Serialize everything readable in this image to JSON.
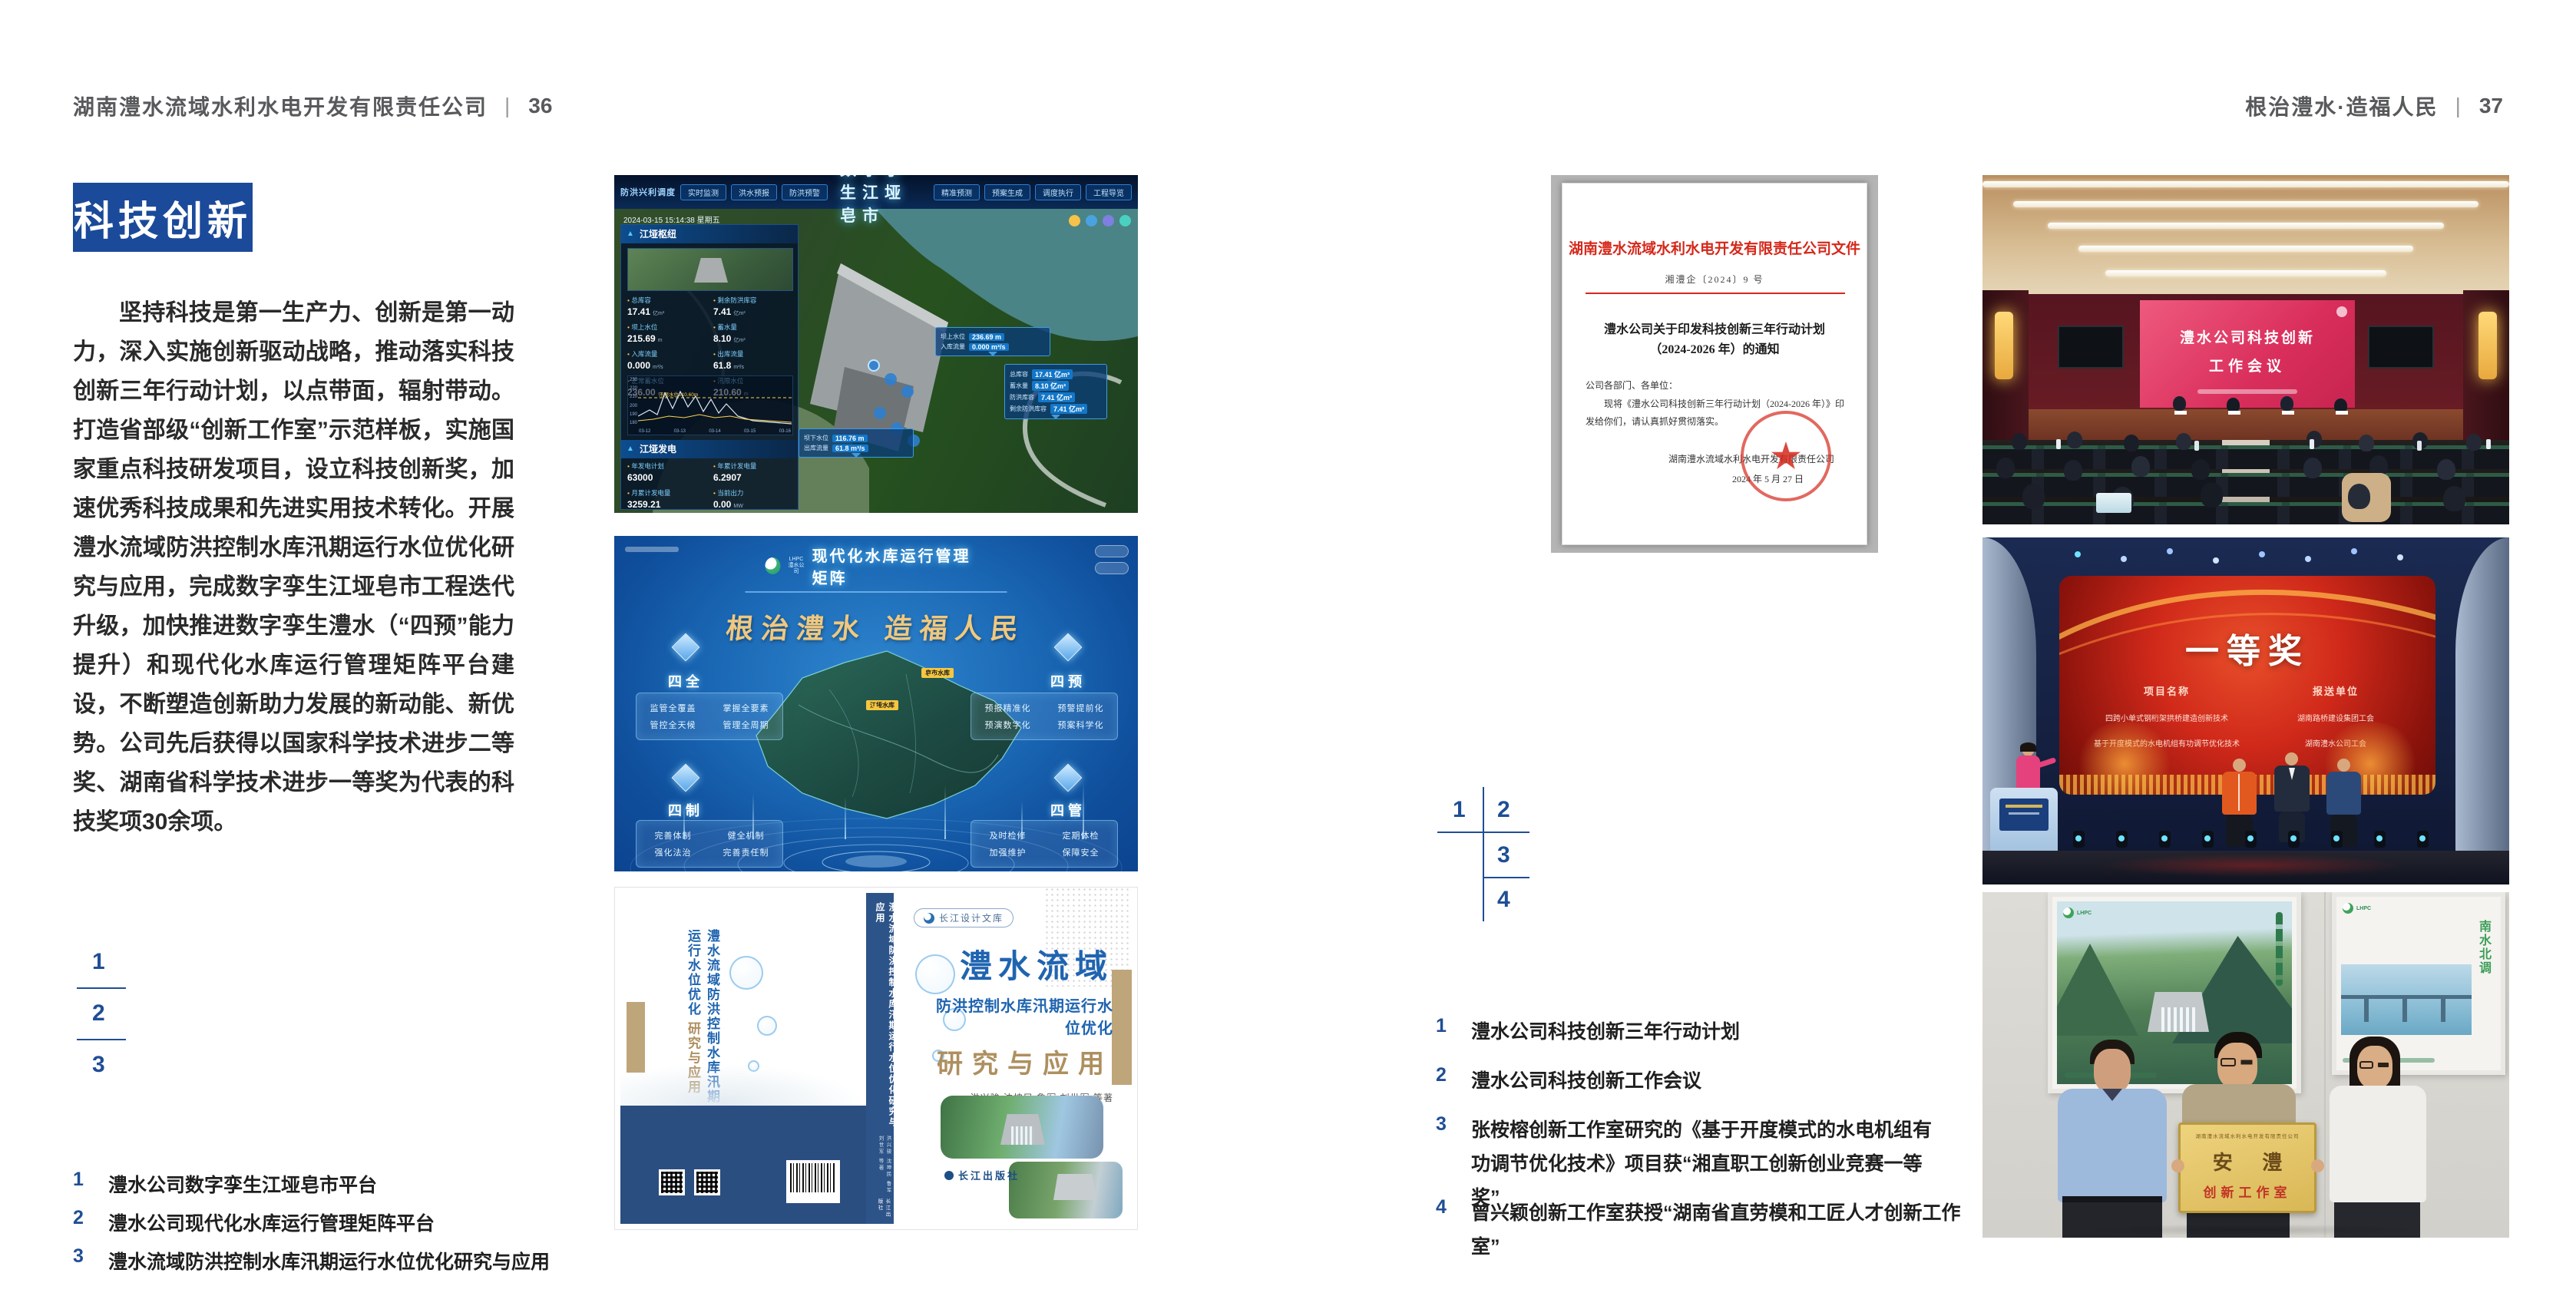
{
  "header": {
    "left": {
      "company": "湖南澧水流域水利水电开发有限责任公司",
      "divider": "|",
      "page": "36"
    },
    "right": {
      "slogan": "根治澧水·造福人民",
      "divider": "|",
      "page": "37"
    }
  },
  "left_page": {
    "section_title": "科技创新",
    "paragraph": "坚持科技是第一生产力、创新是第一动力，深入实施创新驱动战略，推动落实科技创新三年行动计划，以点带面，辐射带动。打造省部级“创新工作室”示范样板，实施国家重点科技研发项目，设立科技创新奖，加速优秀科技成果和先进实用技术转化。开展澧水流域防洪控制水库汛期运行水位优化研究与应用，完成数字孪生江垭皂市工程迭代升级，加快推进数字孪生澧水（“四预”能力提升）和现代化水库运行管理矩阵平台建设，不断塑造创新助力发展的新动能、新优势。公司先后获得以国家科学技术进步二等奖、湖南省科学技术进步一等奖为代表的科技奖项30余项。",
    "index": {
      "n1": "1",
      "n2": "2",
      "n3": "3"
    },
    "captions": [
      {
        "no": "1",
        "text": "澧水公司数字孪生江垭皂市平台"
      },
      {
        "no": "2",
        "text": "澧水公司现代化水库运行管理矩阵平台"
      },
      {
        "no": "3",
        "text": "澧水流域防洪控制水库汛期运行水位优化研究与应用"
      }
    ]
  },
  "right_page": {
    "index": {
      "n1": "1",
      "n2": "2",
      "n3": "3",
      "n4": "4"
    },
    "captions": [
      {
        "no": "1",
        "text": "澧水公司科技创新三年行动计划"
      },
      {
        "no": "2",
        "text": "澧水公司科技创新工作会议"
      },
      {
        "no": "3",
        "text": "张桉榕创新工作室研究的《基于开度模式的水电机组有功调节优化技术》项目获“湘直职工创新创业竞赛一等奖”"
      },
      {
        "no": "4",
        "text": "曾兴颖创新工作室获授“湖南省直劳模和工匠人才创新工作室”"
      }
    ]
  },
  "dashboard": {
    "title": "数字孪生江垭皂市",
    "corner_label": "防洪兴利调度",
    "timestamp": "2024-03-15 15:14:38 星期五",
    "tabs_left": [
      "实时监测",
      "洪水预报",
      "防洪预警"
    ],
    "tabs_right": [
      "精准预测",
      "预案生成",
      "调度执行",
      "工程导览"
    ],
    "panel1_title": "江垭枢纽",
    "panel2_title": "江垭发电",
    "stats1": [
      {
        "label": "总库容",
        "value": "17.41",
        "unit": "亿m³"
      },
      {
        "label": "剩余防洪库容",
        "value": "7.41",
        "unit": "亿m³"
      },
      {
        "label": "坝上水位",
        "value": "215.69",
        "unit": "m"
      },
      {
        "label": "蓄水量",
        "value": "8.10",
        "unit": "亿m³"
      },
      {
        "label": "入库流量",
        "value": "0.000",
        "unit": "m³/s"
      },
      {
        "label": "出库流量",
        "value": "61.8",
        "unit": "m³/s"
      },
      {
        "label": "正常蓄水位",
        "value": "236.00",
        "unit": "m"
      },
      {
        "label": "汛限水位",
        "value": "210.60",
        "unit": "m"
      }
    ],
    "chart": {
      "annotation": "汛限水位210.60m",
      "y_ticks": [
        "230",
        "220",
        "210",
        "200",
        "190",
        "180"
      ],
      "x_ticks": [
        "03-12",
        "03-13",
        "03-14",
        "03-15",
        "03-16"
      ]
    },
    "stats2": [
      {
        "label": "年发电计划",
        "value": "63000",
        "unit": ""
      },
      {
        "label": "年累计发电量",
        "value": "6.2907",
        "unit": ""
      },
      {
        "label": "月累计发电量",
        "value": "3259.21",
        "unit": ""
      },
      {
        "label": "当前出力",
        "value": "0.00",
        "unit": "MW"
      },
      {
        "label": "发电流量",
        "value": "0.00",
        "unit": "m³/s"
      },
      {
        "label": "弃水流量",
        "value": "0.00",
        "unit": "m³/s"
      }
    ],
    "callout_up": {
      "rows": [
        [
          "坝上水位",
          "236.69 m"
        ],
        [
          "入库流量",
          "0.000 m³/s"
        ]
      ]
    },
    "callout_res": {
      "rows": [
        [
          "总库容",
          "17.41 亿m³"
        ],
        [
          "蓄水量",
          "8.10 亿m³"
        ],
        [
          "防洪库容",
          "7.41 亿m³"
        ],
        [
          "剩余防洪库容",
          "7.41 亿m³"
        ]
      ]
    },
    "callout_down": {
      "rows": [
        [
          "坝下水位",
          "116.76 m"
        ],
        [
          "出库流量",
          "61.8 m³/s"
        ]
      ]
    }
  },
  "matrix": {
    "logo_line1": "LHPC",
    "logo_line2": "澧水公司",
    "title": "现代化水库运行管理矩阵",
    "slogan": "根治澧水  造福人民",
    "groups": [
      {
        "name": "四全",
        "items": [
          "监管全覆盖",
          "掌握全要素",
          "管控全天候",
          "管理全周期"
        ]
      },
      {
        "name": "四预",
        "items": [
          "预报精准化",
          "预警提前化",
          "预演数字化",
          "预案科学化"
        ]
      },
      {
        "name": "四制",
        "items": [
          "完善体制",
          "健全机制",
          "强化法治",
          "完善责任制"
        ]
      },
      {
        "name": "四管",
        "items": [
          "及时检修",
          "定期体检",
          "加强维护",
          "保障安全"
        ]
      }
    ],
    "map_labels": [
      "皂市水库",
      "江垭水库"
    ]
  },
  "book": {
    "series": "长江设计文库",
    "title_line1": "澧水流域",
    "title_line2": "防洪控制水库汛期运行水位优化",
    "title_line3": "研究与应用",
    "authors": "洪兴骏  沈坤民  鲁军  刘世军  等著",
    "spine_title": "澧水流域防洪控制水库汛期运行水位优化研究与应用",
    "back_title": "澧水流域防洪控制水库汛期运行水位优化",
    "back_title2": "研究与应用",
    "publisher": "长江出版社"
  },
  "document": {
    "header": "湖南澧水流域水利水电开发有限责任公司文件",
    "doc_no": "湘澧企〔2024〕9 号",
    "title_line1": "澧水公司关于印发科技创新三年行动计划",
    "title_line2": "（2024-2026 年）的通知",
    "salutation": "公司各部门、各单位：",
    "body": "现将《澧水公司科技创新三年行动计划（2024-2026 年）》印发给你们，请认真抓好贯彻落实。",
    "signer": "湖南澧水流域水利水电开发有限责任公司",
    "date": "2024 年 5 月 27 日",
    "seal_star": "★"
  },
  "meeting": {
    "screen_line1": "澧水公司科技创新",
    "screen_line2": "工作会议"
  },
  "award": {
    "headline": "一等奖",
    "col1_header": "项目名称",
    "col2_header": "报送单位",
    "row1_project": "四跨小单式钢桁架拱桥建造创新技术",
    "row2_project": "基于开度模式的水电机组有功调节优化技术",
    "row1_unit": "湖南路桥建设集团工会",
    "row2_unit": "湖南澧水公司工会"
  },
  "plaque": {
    "board_header": "湖南澧水流域水利水电开发有限责任公司",
    "board_title": "安  澧",
    "board_subtitle": "创新工作室",
    "poster_right_text": "南水北调",
    "logo_text": "LHPC"
  },
  "colors": {
    "accent_blue": "#1b4a9a",
    "index_blue": "#1f4e96",
    "doc_red": "#d5281b",
    "book_navy": "#2b4e80",
    "title_blue": "#1f64b0",
    "tan": "#b3986a"
  }
}
